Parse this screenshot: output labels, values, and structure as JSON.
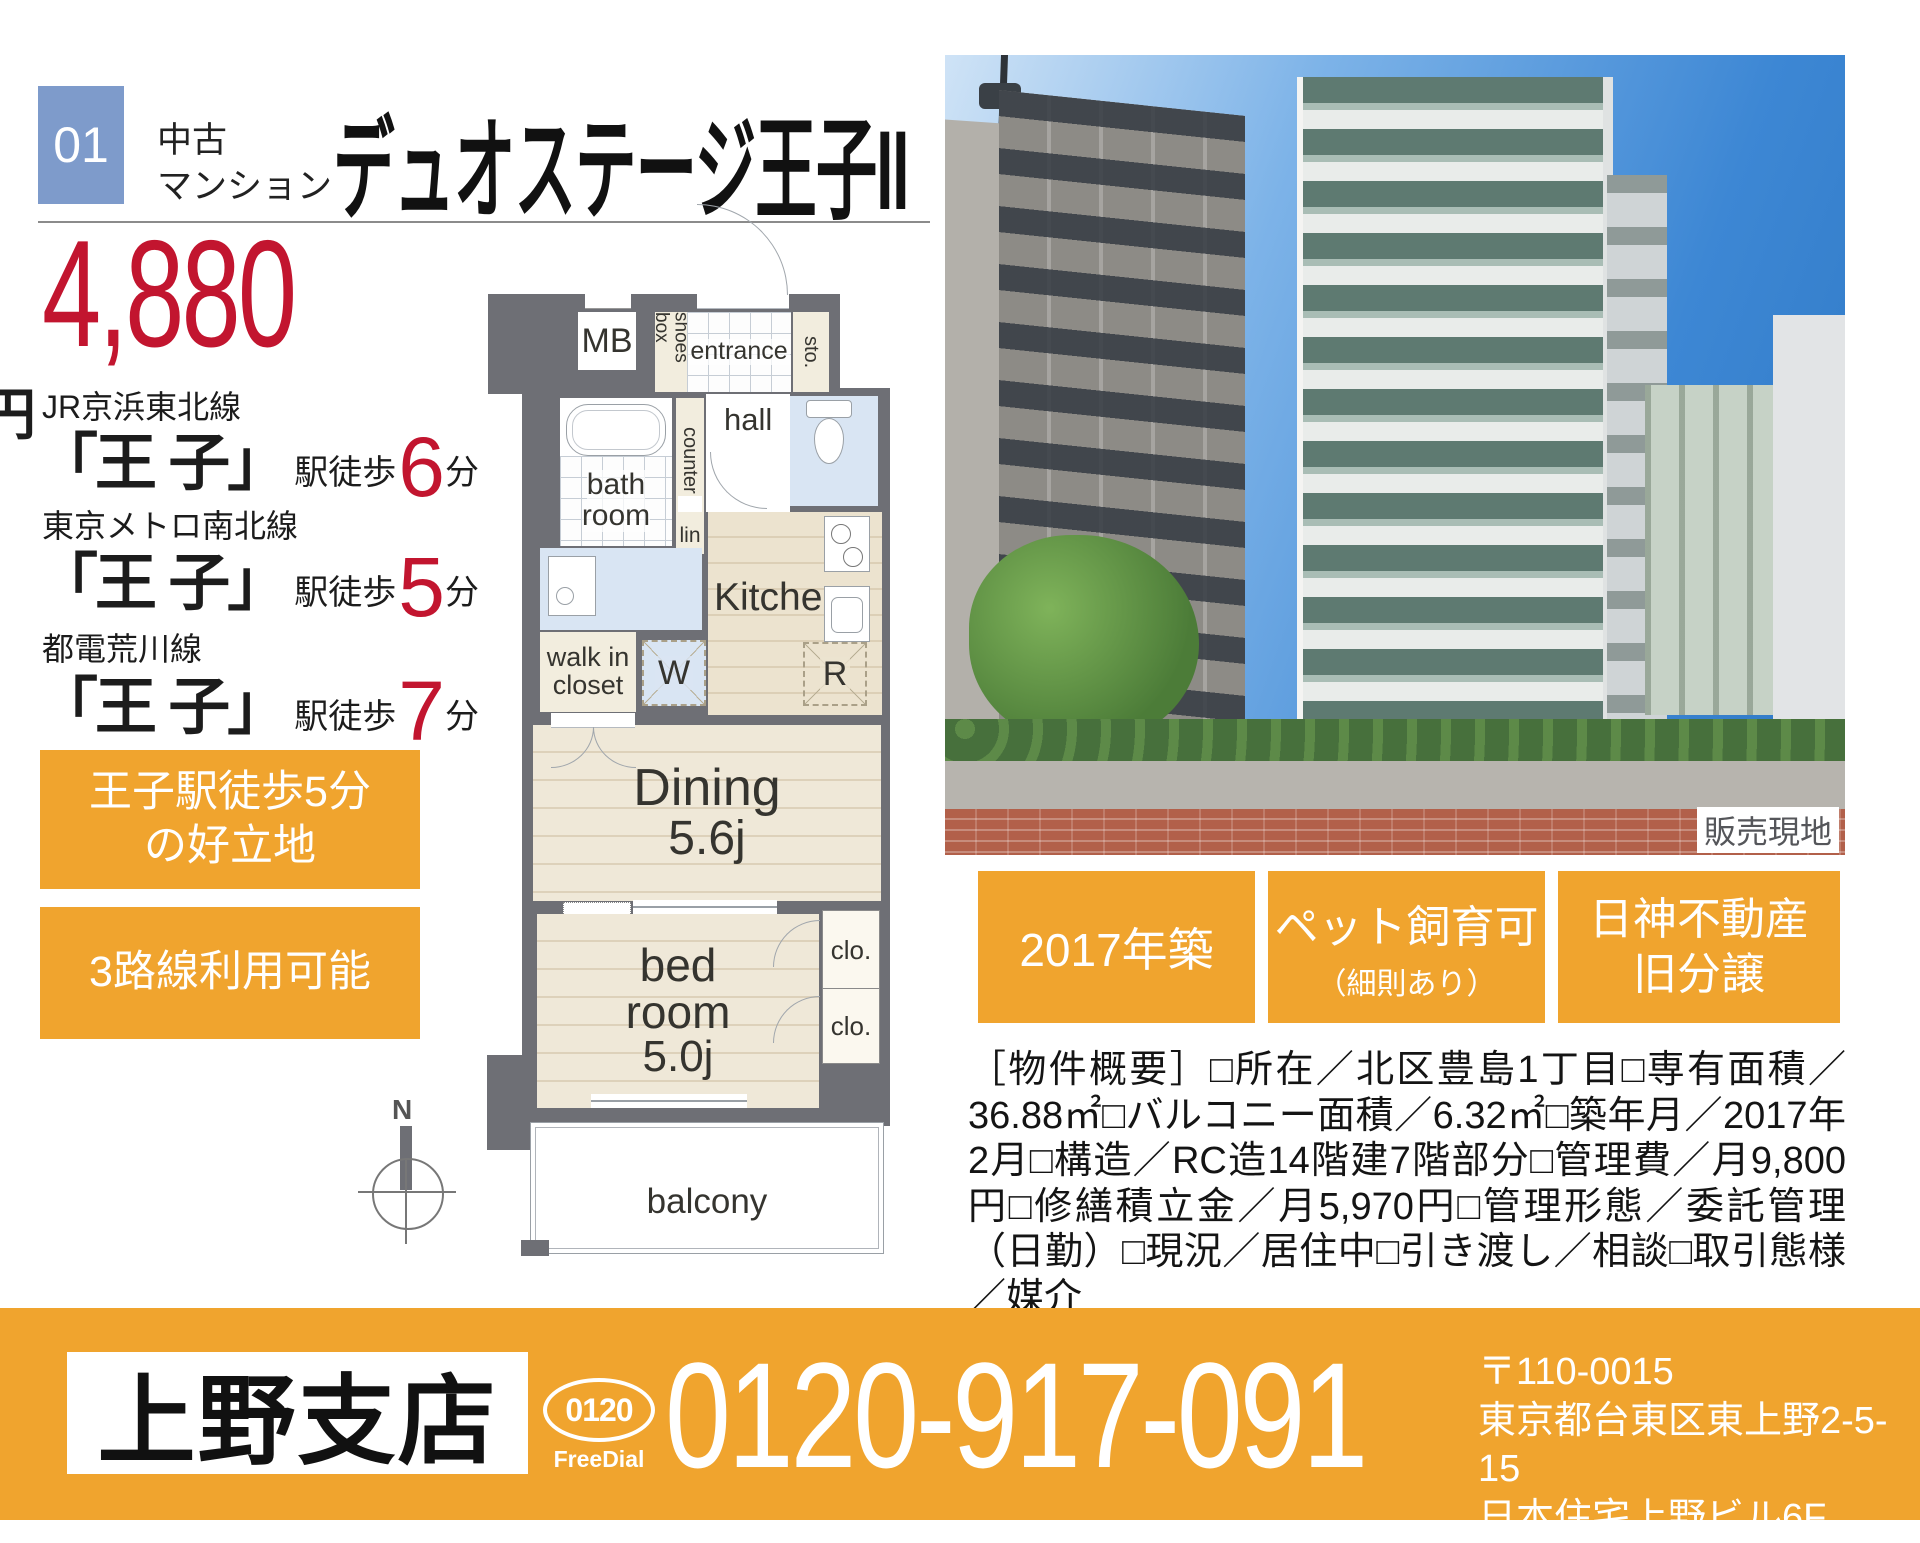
{
  "colors": {
    "accent_orange": "#f0a42e",
    "price_red": "#c2152f",
    "index_blue": "#7e9bcb",
    "wall_gray": "#6e6f75"
  },
  "header": {
    "index": "01",
    "category_line1": "中古",
    "category_line2": "マンション",
    "title": "デュオステージ王子II"
  },
  "price": {
    "amount": "4,880",
    "unit": "万円"
  },
  "stations": [
    {
      "line": "JR京浜東北線",
      "station": "「王 子」",
      "walk": "駅徒歩",
      "minutes": "6",
      "unit": "分"
    },
    {
      "line": "東京メトロ南北線",
      "station": "「王 子」",
      "walk": "駅徒歩",
      "minutes": "5",
      "unit": "分"
    },
    {
      "line": "都電荒川線",
      "station": "「王 子」",
      "walk": "駅徒歩",
      "minutes": "7",
      "unit": "分"
    }
  ],
  "highlights": [
    {
      "line1": "王子駅徒歩5分",
      "line2": "の好立地"
    },
    {
      "line1": "3路線利用可能",
      "line2": ""
    }
  ],
  "floorplan": {
    "mb": "MB",
    "shoes_box": "shoes box",
    "entrance": "entrance",
    "storage": "sto.",
    "counter": "counter",
    "hall": "hall",
    "linen": "lin",
    "bath_line1": "bath",
    "bath_line2": "room",
    "kitchen": "Kitchen",
    "washer": "W",
    "fridge": "R",
    "walkin_line1": "walk in",
    "walkin_line2": "closet",
    "dining_line1": "Dining",
    "dining_line2": "5.6j",
    "bed_line1": "bed",
    "bed_line2": "room",
    "bed_line3": "5.0j",
    "closet1": "clo.",
    "closet2": "clo.",
    "balcony": "balcony",
    "compass": "N"
  },
  "photo": {
    "site_label": "販売現地"
  },
  "badges": [
    {
      "line1": "2017年築",
      "line2": ""
    },
    {
      "line1": "ペット飼育可",
      "line2": "（細則あり）"
    },
    {
      "line1": "日神不動産",
      "line2": "旧分譲"
    }
  ],
  "overview": {
    "text": "［物件概要］□所在／北区豊島1丁目□専有面積／36.88㎡□バルコニー面積／6.32㎡□築年月／2017年2月□構造／RC造14階建7階部分□管理費／月9,800円□修繕積立金／月5,970円□管理形態／委託管理（日勤）□現況／居住中□引き渡し／相談□取引態様／媒介"
  },
  "footer": {
    "branch": "上野支店",
    "freedial_top": "0120",
    "freedial_label": "FreeDial",
    "phone": "0120-917-091",
    "postal": "〒110-0015",
    "address1": "東京都台東区東上野2-5-15",
    "address2": "日本住宅上野ビル6F"
  }
}
